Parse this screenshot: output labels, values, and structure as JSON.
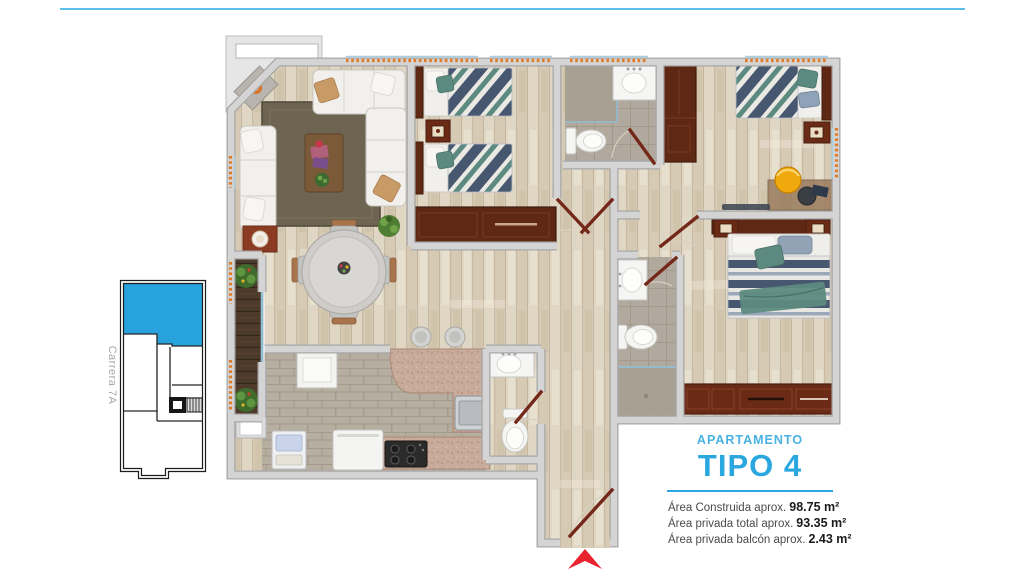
{
  "page": {
    "accent_blue": "#2ba7e0",
    "top_rule_color": "#5abfe9",
    "arrow_red": "#e8232e"
  },
  "key_plan": {
    "street_label": "Carrera 7A",
    "highlight_color": "#29a3dd"
  },
  "title_block": {
    "kicker": "APARTAMENTO",
    "title": "TIPO 4",
    "areas": [
      {
        "label": "Área Construida aprox.",
        "value": "98.75 m²"
      },
      {
        "label": "Área privada total aprox.",
        "value": "93.35 m²"
      },
      {
        "label": "Área privada balcón aprox.",
        "value": "2.43 m²"
      }
    ]
  }
}
